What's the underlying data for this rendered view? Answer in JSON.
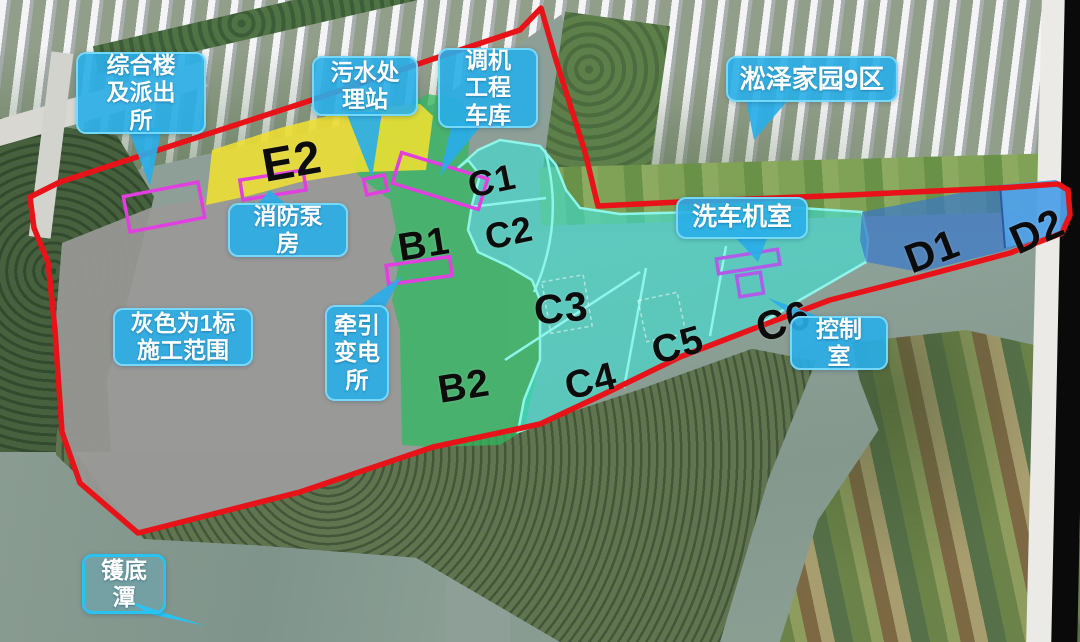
{
  "map_overlay": {
    "zone_labels": [
      {
        "id": "E2",
        "text": "E2"
      },
      {
        "id": "B1",
        "text": "B1"
      },
      {
        "id": "B2",
        "text": "B2"
      },
      {
        "id": "C1",
        "text": "C1"
      },
      {
        "id": "C2",
        "text": "C2"
      },
      {
        "id": "C3",
        "text": "C3"
      },
      {
        "id": "C4",
        "text": "C4"
      },
      {
        "id": "C5",
        "text": "C5"
      },
      {
        "id": "C6",
        "text": "C6"
      },
      {
        "id": "D1",
        "text": "D1"
      },
      {
        "id": "D2",
        "text": "D2"
      }
    ],
    "callouts": [
      {
        "id": "comprehensive-building-police",
        "lines": [
          "综合楼",
          "及派出",
          "所"
        ]
      },
      {
        "id": "sewage-treatment-station",
        "lines": [
          "污水处",
          "理站"
        ]
      },
      {
        "id": "shunting-engineering-garage",
        "lines": [
          "调机",
          "工程",
          "车库"
        ]
      },
      {
        "id": "songze-homeland-district9",
        "lines": [
          "淞泽家园9区"
        ]
      },
      {
        "id": "fire-pump-house",
        "lines": [
          "消防泵",
          "房"
        ]
      },
      {
        "id": "gray-scope-note",
        "lines": [
          "灰色为1标",
          "施工范围"
        ]
      },
      {
        "id": "traction-substation",
        "lines": [
          "牵引",
          "变电",
          "所"
        ]
      },
      {
        "id": "car-wash-machine-room",
        "lines": [
          "洗车机室"
        ]
      },
      {
        "id": "control-room",
        "lines": [
          "控制",
          "室"
        ]
      },
      {
        "id": "huodi-pond",
        "lines": [
          "镬底",
          "潭"
        ]
      }
    ],
    "colors": {
      "boundary_red": "#e81318",
      "callout_cyan": "#29aee8",
      "zone_yellow": "#f0e030",
      "zone_green": "#3cb964",
      "zone_cyan": "#45e0d6",
      "zone_gray": "#9a9997",
      "zone_blue_d1": "#3a78c8",
      "zone_blue_d2": "#52a8ee",
      "marker_magenta": "#e23fe0",
      "marker_violet": "#b05ce8"
    }
  }
}
